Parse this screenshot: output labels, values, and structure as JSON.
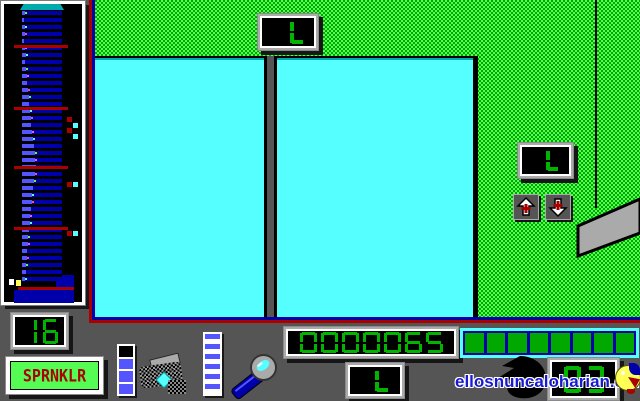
{
  "title": "SPRNKLR game screen",
  "colors": {
    "ega_green": "#00a800",
    "ega_lgreen": "#54fc54",
    "ega_cyan": "#55ffff",
    "ega_teal": "#00aaaa",
    "ega_blue": "#0000aa",
    "ega_lblue": "#5555ff",
    "ega_red": "#aa0000",
    "gray": "#aaaaaa",
    "dark_gray": "#555555",
    "segment_green": "#00b400"
  },
  "sidebar": {
    "counter": "16",
    "label": "SPRNKLR",
    "tower": {
      "fills": [
        3,
        2,
        3,
        3,
        2,
        3,
        4,
        3,
        4,
        5,
        5,
        6,
        7,
        7,
        8,
        9,
        9,
        10,
        11,
        12,
        13,
        13,
        14,
        13,
        12,
        11,
        10,
        10,
        9,
        8,
        8,
        7,
        6,
        6,
        5,
        5,
        4,
        4,
        3
      ],
      "dot_palette": [
        "#55ff55",
        "#ff55ff",
        "#55ffff",
        "#ff5555"
      ],
      "red_lines": [
        45,
        107,
        166,
        227
      ],
      "base_line": 287,
      "indicators": [
        {
          "c": "#aa0000",
          "x": 67,
          "y": 117
        },
        {
          "c": "#55ffff",
          "x": 73,
          "y": 123
        },
        {
          "c": "#aa0000",
          "x": 67,
          "y": 128
        },
        {
          "c": "#55ffff",
          "x": 73,
          "y": 134
        },
        {
          "c": "#aa0000",
          "x": 67,
          "y": 182
        },
        {
          "c": "#55ffff",
          "x": 73,
          "y": 182
        },
        {
          "c": "#aa0000",
          "x": 67,
          "y": 231
        },
        {
          "c": "#55ffff",
          "x": 73,
          "y": 231
        }
      ]
    }
  },
  "hud": {
    "score": "0000065",
    "top_indicator": "L",
    "right_indicator": "L",
    "bottom_indicator": "L",
    "right_counter": "03",
    "water_gauge": {
      "segments": 8,
      "on_color": "#00a800"
    },
    "supply_gauge": {
      "cells": [
        "#000000",
        "#5555ff",
        "#5555ff",
        "#5555ff"
      ]
    },
    "ladder_gauge": {
      "stripes": 12,
      "a": "#5555ff",
      "b": "#ffffff"
    }
  },
  "watermark": {
    "text": "ellosnuncaloharian.com"
  }
}
